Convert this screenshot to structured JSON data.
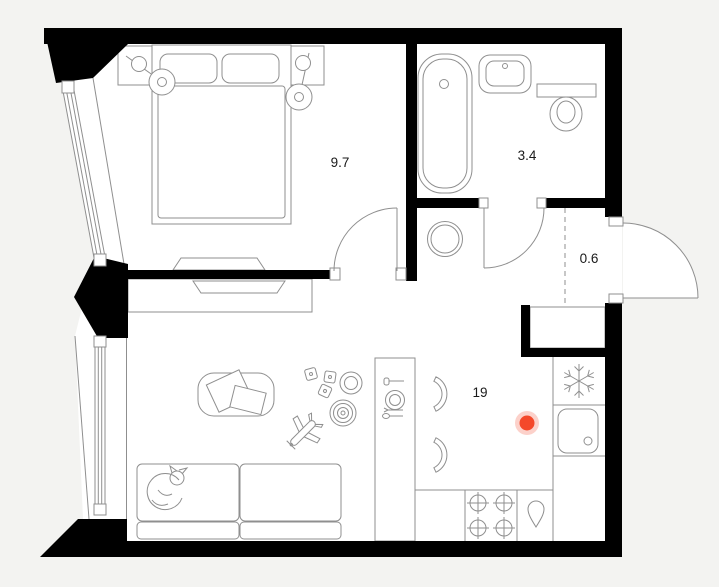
{
  "floor_plan": {
    "type": "apartment-floor-plan",
    "room_labels": {
      "bedroom": "9.7",
      "bathroom": "3.4",
      "hallway": "0.6",
      "living_kitchen": "19"
    },
    "areas_sqm": {
      "bedroom": 9.7,
      "bathroom": 3.4,
      "hallway": 0.6,
      "living_kitchen": 19
    },
    "fixtures": {
      "bedroom": [
        "double-bed",
        "pillows",
        "headboard-console",
        "wall-lamp-left",
        "wall-lamp-right",
        "tv",
        "angled-window"
      ],
      "bathroom": [
        "bathtub",
        "washbasin",
        "toilet",
        "door-swing"
      ],
      "hallway": [
        "entrance-door-swing",
        "wardrobe",
        "washing-machine",
        "boundary-dashed-line"
      ],
      "living_kitchen": [
        "sofa",
        "sleeping-cat",
        "coffee-table",
        "magazines",
        "toy-blocks",
        "toy-ring",
        "ring-pyramid-toy",
        "toy-plane",
        "tv-console",
        "tv",
        "dining-table",
        "place-setting",
        "chair",
        "chair",
        "refrigerator-snowflake",
        "kitchen-sink",
        "stove-4-burners",
        "water-drop-symbol",
        "window"
      ]
    },
    "marker": {
      "name": "location-marker",
      "color": "#f4482a"
    },
    "colors": {
      "bg": "#f3f3f1",
      "floor": "#ffffff",
      "wall": "#000000",
      "line": "#8f8f8f",
      "label": "#1a1a1a",
      "marker": "#f4482a",
      "marker_halo": "rgba(244,72,42,0.25)"
    }
  }
}
